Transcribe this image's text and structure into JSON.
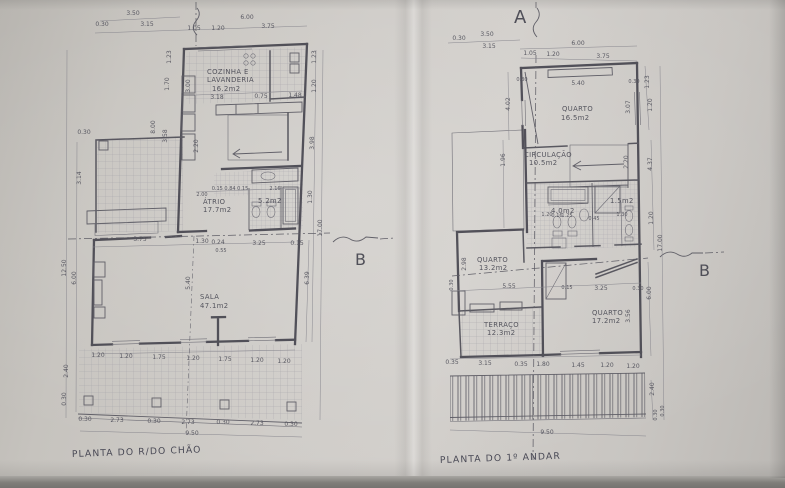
{
  "photo": {
    "paper_color": "#cfccc8",
    "ink_color": "#4b4a53"
  },
  "ground": {
    "title": "PLANTA DO R/DO CHÃO",
    "rooms": {
      "kitchen1": "COZINHA E",
      "kitchen2": "LAVANDERIA",
      "kitchen_area": "16.2m2",
      "atrio": "ÁTRIO",
      "atrio_area": "17.7m2",
      "wc_area": "5.2m2",
      "sala": "SALA",
      "sala_area": "47.1m2"
    },
    "dims": {
      "top": [
        "3.50",
        "0.30",
        "3.15",
        "6.00",
        "1.05",
        "1.20",
        "3.75"
      ],
      "kitchen": [
        "3.00",
        "3.18",
        "0.75",
        "1.48"
      ],
      "left_inner": [
        "1.23",
        "1.70",
        "8.00",
        "3.58",
        "2.20"
      ],
      "left_outer": [
        "0.30",
        "3.14",
        "12.50",
        "6.00",
        "2.40",
        "0.30"
      ],
      "right": [
        "1.23",
        "1.20",
        "3.98",
        "1.30",
        "17.00",
        "6.39"
      ],
      "atrio": [
        "2.00",
        "0.15 0.84 0.15",
        "2.16"
      ],
      "sala_top": [
        "3.75",
        "1.30",
        "0.24",
        "3.25",
        "0.15",
        "0.55"
      ],
      "sala_height": "5.40",
      "sala_bottom": [
        "1.20",
        "1.20",
        "1.75",
        "1.20",
        "1.75",
        "1.20",
        "1.20"
      ],
      "terrace": [
        "0.30",
        "2.73",
        "0.30",
        "2.73",
        "0.30",
        "2.73",
        "0.30"
      ],
      "total": "9.50"
    }
  },
  "first": {
    "title": "PLANTA DO 1º ANDAR",
    "rooms": {
      "quarto1": "QUARTO",
      "quarto1_area": "16.5m2",
      "circ": "CIRCULAÇÃO",
      "circ_area": "10.5m2",
      "quarto2": "QUARTO",
      "quarto2_area": "13.2m2",
      "terraco": "TERRAÇO",
      "terraco_area": "12.3m2",
      "quarto3": "QUARTO",
      "quarto3_area": "17.2m2",
      "wc1_area": "4.0m2",
      "wc2_area": "1.5m2"
    },
    "dims": {
      "top": [
        "3.50",
        "0.30",
        "3.15",
        "6.00",
        "1.05",
        "1.20",
        "3.75"
      ],
      "quarto1": [
        "0.30",
        "5.40",
        "0.30",
        "4.02",
        "3.07"
      ],
      "right": [
        "1.23",
        "1.20",
        "2.20",
        "4.37",
        "1.20",
        "17.00",
        "6.00"
      ],
      "mid": [
        "2.98",
        "5.55",
        "0.30",
        "0.15",
        "3.25",
        "0.30",
        "3.56",
        "1.96"
      ],
      "bath": [
        "1.20",
        "0.16",
        "1.25",
        "0.45",
        "1.30"
      ],
      "bottom": [
        "0.35",
        "3.15",
        "0.35",
        "1.80",
        "1.45",
        "1.20",
        "1.20"
      ],
      "bottom_right": [
        "2.40",
        "0.30",
        "0.30"
      ],
      "total": "9.50"
    }
  },
  "markers": {
    "a": "A",
    "b1": "B",
    "b2": "B"
  }
}
